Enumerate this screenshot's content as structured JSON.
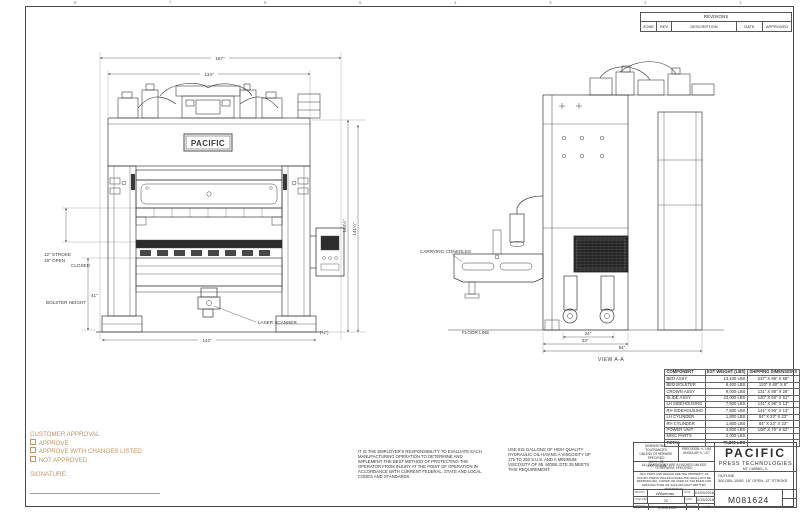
{
  "colors": {
    "accent": "#c6935c",
    "line": "#3a3a3a"
  },
  "zones": {
    "n8": "8",
    "n7": "7",
    "n6": "6",
    "n5": "5",
    "n4": "4",
    "n3": "3",
    "n2": "2",
    "n1": "1"
  },
  "revisions": {
    "title": "REVISIONS",
    "col_zone": "ZONE",
    "col_rev": "REV",
    "col_desc": "DESCRIPTION",
    "col_date": "DATE",
    "col_appr": "APPROVED"
  },
  "front_view": {
    "logo": "PACIFIC",
    "dim_overall_width": "167\"",
    "dim_inner_width": "134\"",
    "dim_base_width": "142\"",
    "dim_height_1": "144½\"",
    "dim_height_2": "141½\"",
    "dim_foot": "(¾\")",
    "label_stroke": "12\" STROKE",
    "label_open": "18\" OPEN",
    "label_closed": "CLOSED",
    "dim_bolster": "41\"",
    "label_bolster": "BOLSTER HEIGHT",
    "label_laser": "LASER SCANNER"
  },
  "side_view": {
    "label_consoles": "CARRYING CONSOLES",
    "label_floor": "FLOOR LINE",
    "label_view": "VIEW A-A",
    "dim_1": "24\"",
    "dim_2": "33\"",
    "dim_3": "54\""
  },
  "approval": {
    "title": "CUSTOMER APPROVAL",
    "options": [
      "APPROVE",
      "APPROVE WITH CHANGES LISTED",
      "NOT APPROVED"
    ],
    "signature_label": "SIGNATURE:"
  },
  "notes": {
    "employer": "IT IS THE EMPLOYER'S RESPONSIBILITY TO EVALUATE EACH MANUFACTURING OPERATION TO DETERMINE AND IMPLEMENT THE BEST METHOD OF PROTECTING THE OPERATOR FROM INJURY AT THE POINT OF OPERATION IN ACCORDANCE WITH CURRENT FEDERAL, STATE AND LOCAL CODES AND STANDARDS.",
    "oil": "USE 515 GALLONS OF HIGH QUALITY HYDRAULIC OIL HAVING A VISCOSITY OF 175 TO 250 S.U.S. AND A MINIMUM VISCOSITY OF 95.  MOBIL DTE 25 MEETS THIS REQUIREMENT."
  },
  "components": {
    "col_name": "COMPONENT",
    "col_weight": "EST WEIGHT (LBS)",
    "col_dims": "SHIPPING DIMENSIONS",
    "rows": [
      {
        "name": "BED ASSY",
        "weight": "13,100 LBS",
        "dims": "237\" X 86\" X 56\""
      },
      {
        "name": "BED BOLSTER",
        "weight": "9,400 LBS",
        "dims": "120\" X 60\" X 6\""
      },
      {
        "name": "CROWN ASSY",
        "weight": "9,000 LBS",
        "dims": "131\" X 88\" X 28\""
      },
      {
        "name": "SLIDE ASSY",
        "weight": "23,000 LBS",
        "dims": "120\" X 60\" X 61\""
      },
      {
        "name": "LH SIDEHOUSING",
        "weight": "7,500 LBS",
        "dims": "141\" X 96\" X 13\""
      },
      {
        "name": "RH SIDEHOUSING",
        "weight": "7,500 LBS",
        "dims": "141\" X 96\" X 13\""
      },
      {
        "name": "LH CYLINDER",
        "weight": "1,800 LBS",
        "dims": "84\" X 23\" X 23\""
      },
      {
        "name": "RH CYLINDER",
        "weight": "1,800 LBS",
        "dims": "84\" X 23\" X 23\""
      },
      {
        "name": "POWER UNIT",
        "weight": "4,500 LBS",
        "dims": "108\" X 70\" X 62\""
      },
      {
        "name": "MISC PARTS",
        "weight": "2,000 LBS",
        "dims": ""
      }
    ],
    "total_name": "TOTAL",
    "total_weight": "79,800 LBS",
    "total_dims": ""
  },
  "title_block": {
    "tol_title1": "DIMENSIONAL TOLERANCES",
    "tol_title2": "UNLESS OTHERWISE SPECIFIED",
    "tol_xx": ".XX +/- .02",
    "tol_xxx": ".XXX +/- .005",
    "tol_frac": "PRECISION +/- 1/64",
    "tol_ang": "ANGULAR +/- 1/2°",
    "units_note": "ALL DIMENSIONS ARE IN INCHES UNLESS OTHERWISE SPECIFIED",
    "proprietary": "THIS PRINT AND DESIGN ARE THE PROPERTY OF PACIFIC PRESS TECHNOLOGIES AND SHALL NOT BE REPRODUCED, COPIED OR USED AS THE BASIS FOR MANUFACTURE OR SALE WITHOUT WRITTEN PERMISSION.",
    "company_name": "PACIFIC",
    "company_sub": "PRESS TECHNOLOGIES",
    "company_loc": "MT. CARMEL, IL",
    "title_label": "OUTLINE",
    "title_value": "300 DBL-10/60, 18\" OPEN, 12\" STROKE",
    "drawn_label": "DRAWN",
    "drawn_value": "LWiseman",
    "drawn_date_label": "DATE",
    "drawn_date": "01/09/2018",
    "check_label": "CHECKED",
    "check_value": "JC",
    "check_date_label": "DATE",
    "check_date": "2/15/2018",
    "weight_label": "WEIGHT",
    "weight_value": "0,000 LBS",
    "scale_label": "SCALE",
    "scale_value": "1:16",
    "drawing_number": "M081624"
  }
}
